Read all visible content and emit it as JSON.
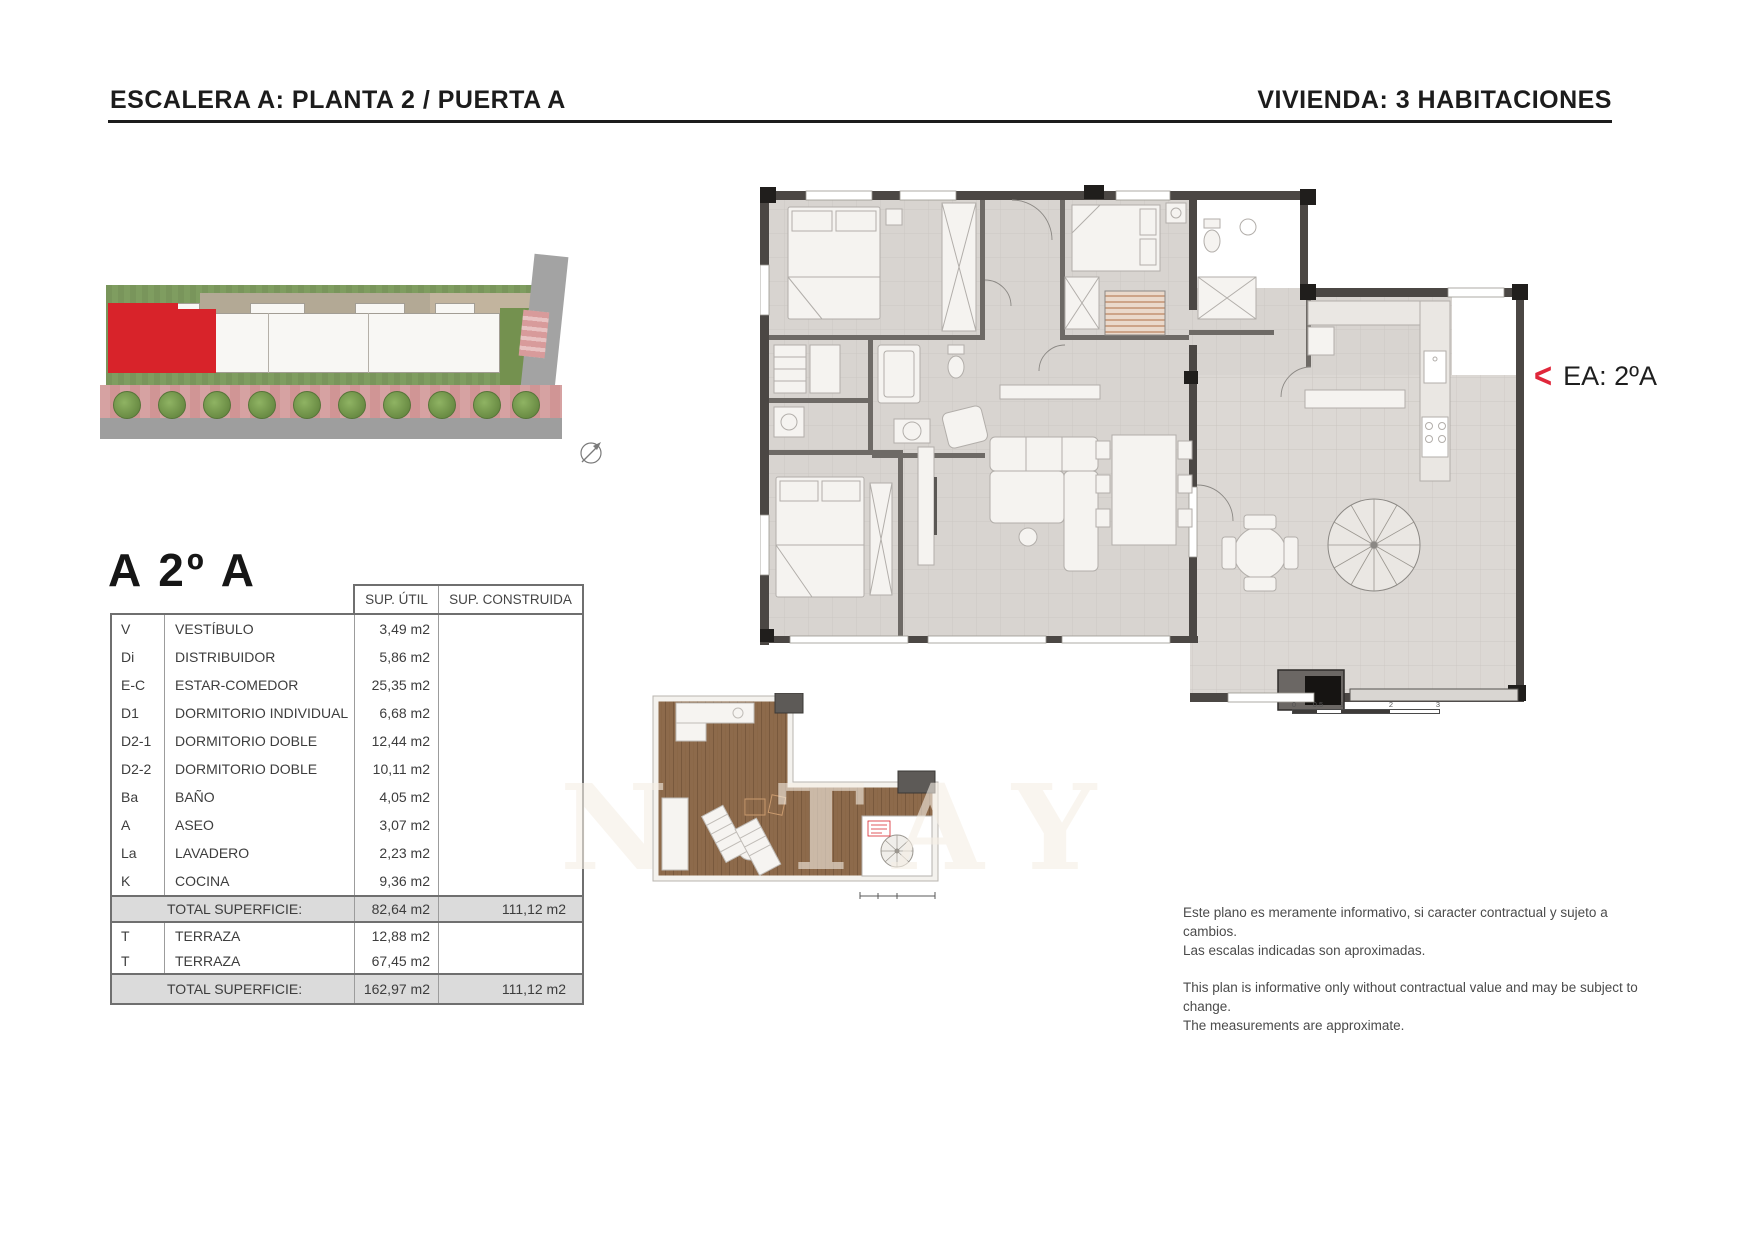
{
  "header": {
    "left": "ESCALERA A: PLANTA 2 / PUERTA A",
    "right": "VIVIENDA: 3 HABITACIONES"
  },
  "unit": {
    "title": "A 2º A",
    "plan_tag": "EA: 2ºA",
    "plan_tag_arrow": "<"
  },
  "surface_table": {
    "headers": {
      "util": "SUP. ÚTIL",
      "construida": "SUP. CONSTRUIDA"
    },
    "rooms": [
      {
        "code": "V",
        "name": "VESTÍBULO",
        "util": "3,49 m2"
      },
      {
        "code": "Di",
        "name": "DISTRIBUIDOR",
        "util": "5,86 m2"
      },
      {
        "code": "E-C",
        "name": "ESTAR-COMEDOR",
        "util": "25,35 m2"
      },
      {
        "code": "D1",
        "name": "DORMITORIO INDIVIDUAL",
        "util": "6,68 m2"
      },
      {
        "code": "D2-1",
        "name": "DORMITORIO DOBLE",
        "util": "12,44 m2"
      },
      {
        "code": "D2-2",
        "name": "DORMITORIO DOBLE",
        "util": "10,11 m2"
      },
      {
        "code": "Ba",
        "name": "BAÑO",
        "util": "4,05 m2"
      },
      {
        "code": "A",
        "name": "ASEO",
        "util": "3,07 m2"
      },
      {
        "code": "La",
        "name": "LAVADERO",
        "util": "2,23 m2"
      },
      {
        "code": "K",
        "name": "COCINA",
        "util": "9,36 m2"
      }
    ],
    "total_interior": {
      "label": "TOTAL SUPERFICIE:",
      "util": "82,64 m2",
      "construida": "111,12 m2"
    },
    "terraces": [
      {
        "code": "T",
        "name": "TERRAZA",
        "util": "12,88 m2"
      },
      {
        "code": "T",
        "name": "TERRAZA",
        "util": "67,45 m2"
      }
    ],
    "total_with_terraces": {
      "label": "TOTAL SUPERFICIE:",
      "util": "162,97 m2",
      "construida": "111,12 m2"
    }
  },
  "scale_bar": {
    "labels": [
      "0",
      "0.5",
      "1",
      "2",
      "3"
    ]
  },
  "disclaimer": {
    "es_line1": "Este plano es meramente informativo, si caracter contractual y sujeto a cambios.",
    "es_line2": "Las escalas indicadas son aproximadas.",
    "en_line1": "This plan is informative only without contractual value and may be subject to change.",
    "en_line2": "The measurements are approximate."
  },
  "watermark": "N TAY",
  "colors": {
    "accent_red": "#d8232a",
    "wall": "#4b4744",
    "floor": "#d8d4d0",
    "wood": "#8d6a4a"
  }
}
